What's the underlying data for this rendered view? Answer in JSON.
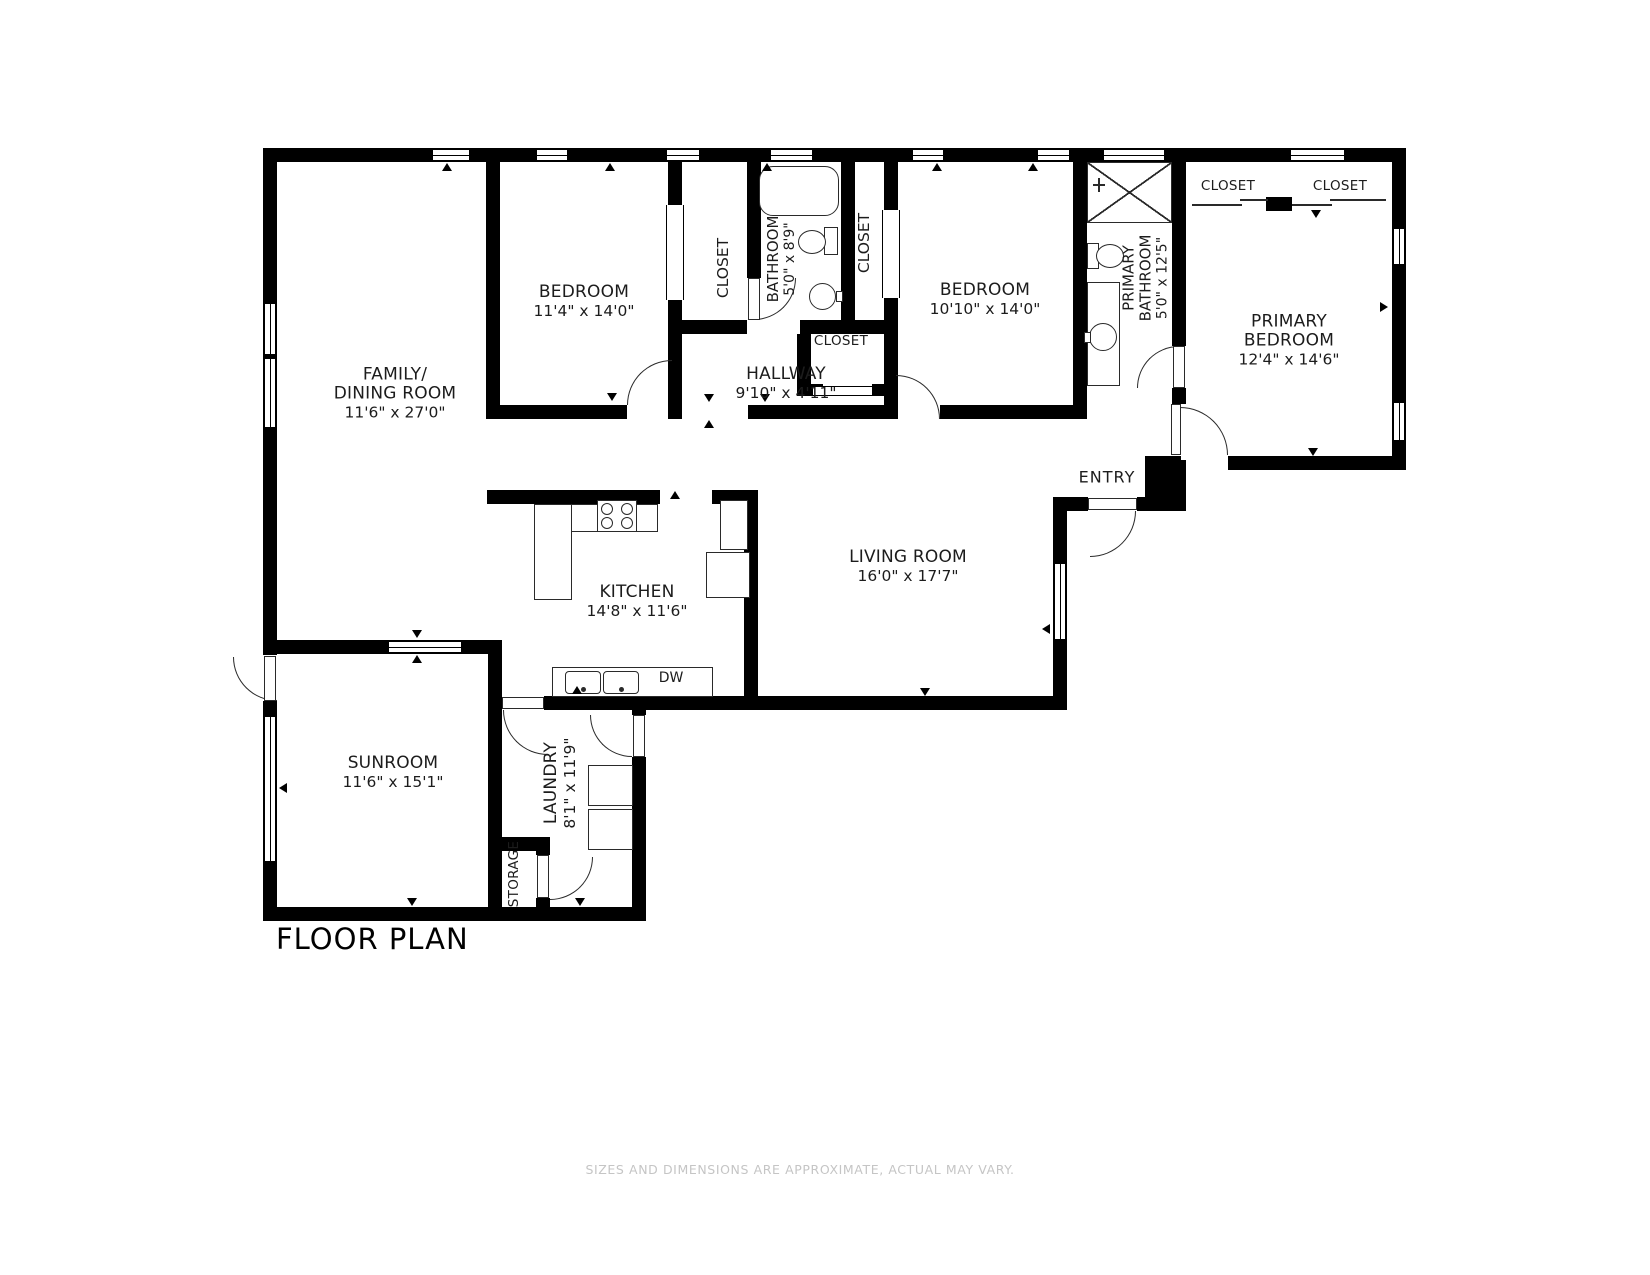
{
  "title": "FLOOR PLAN",
  "disclaimer": "SIZES AND DIMENSIONS ARE APPROXIMATE, ACTUAL MAY VARY.",
  "rooms": {
    "family": {
      "name": "FAMILY/\nDINING ROOM",
      "dims": "11'6\" x 27'0\""
    },
    "bedroom1": {
      "name": "BEDROOM",
      "dims": "11'4\" x 14'0\""
    },
    "bedroom2": {
      "name": "BEDROOM",
      "dims": "10'10\" x 14'0\""
    },
    "primary_bedroom": {
      "name": "PRIMARY\nBEDROOM",
      "dims": "12'4\" x 14'6\""
    },
    "living": {
      "name": "LIVING ROOM",
      "dims": "16'0\" x 17'7\""
    },
    "kitchen": {
      "name": "KITCHEN",
      "dims": "14'8\" x 11'6\""
    },
    "hallway": {
      "name": "HALLWAY",
      "dims": "9'10\" x 4'11\""
    },
    "sunroom": {
      "name": "SUNROOM",
      "dims": "11'6\" x 15'1\""
    },
    "laundry": {
      "name": "LAUNDRY",
      "dims": "8'1\" x 11'9\""
    },
    "bathroom": {
      "name": "BATHROOM",
      "dims": "5'0\" x 8'9\""
    },
    "primary_bathroom": {
      "name": "PRIMARY\nBATHROOM",
      "dims": "5'0\" x 12'5\""
    },
    "storage": {
      "name": "STORAGE"
    },
    "entry": {
      "name": "ENTRY"
    }
  },
  "labels": {
    "closet": "CLOSET",
    "dishwasher": "DW"
  }
}
